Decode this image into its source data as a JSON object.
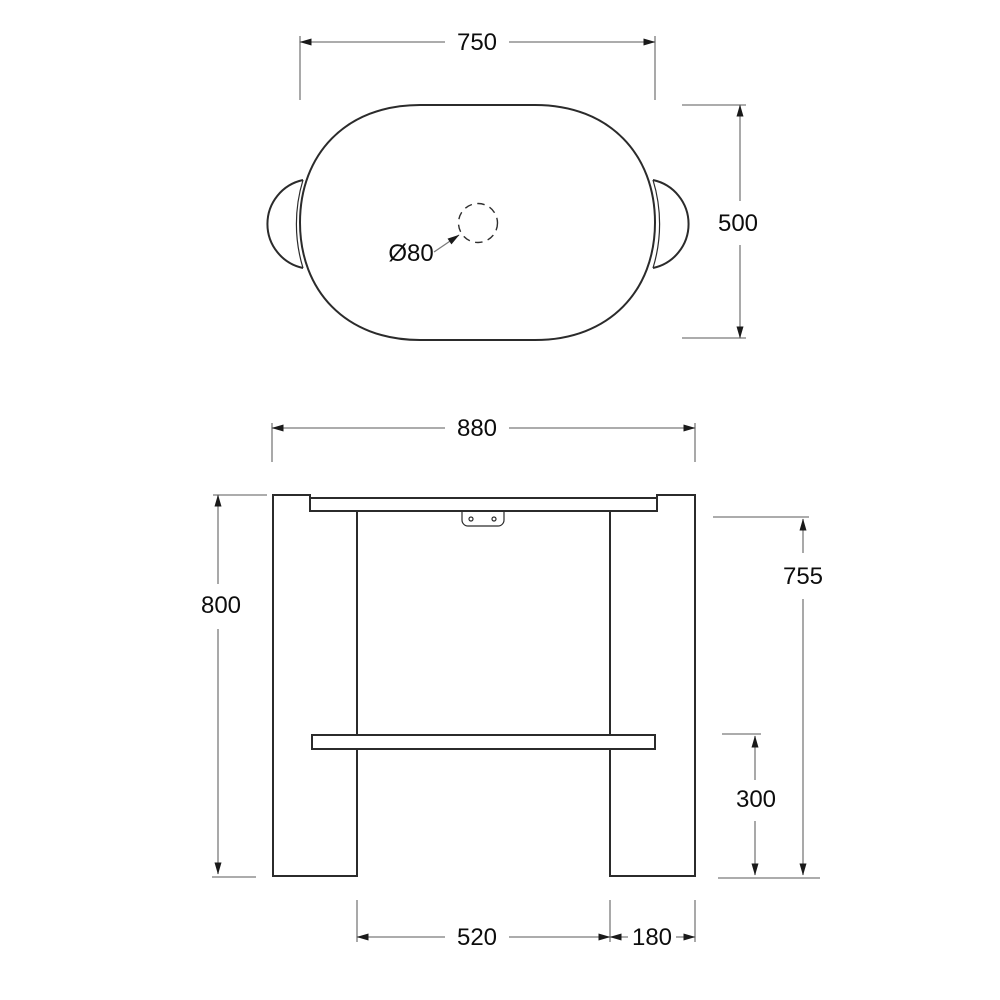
{
  "drawing": {
    "type": "furniture technical drawing, two orthographic views",
    "colors": {
      "background": "#ffffff",
      "object_line": "#2b2b2b",
      "dimension_line": "#7b7b7b",
      "text": "#0d0d0d"
    },
    "top_view": {
      "labels": {
        "width": "750",
        "depth": "500",
        "hole": "Ø80"
      }
    },
    "front_view": {
      "labels": {
        "width": "880",
        "height": "800",
        "clearance": "755",
        "shelf": "300",
        "span": "520",
        "leg": "180"
      }
    }
  }
}
